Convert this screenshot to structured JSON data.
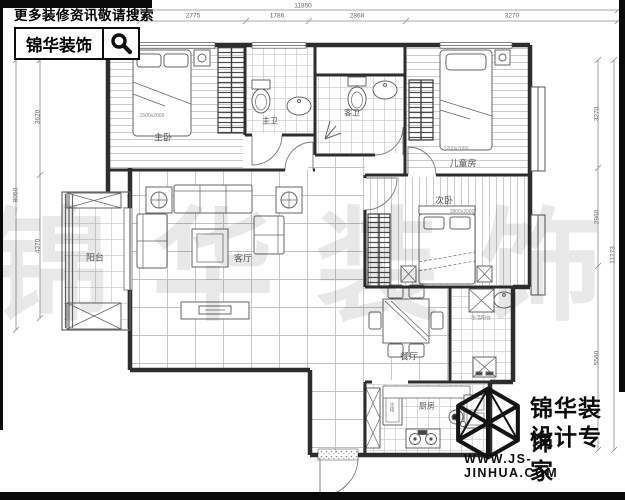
{
  "branding_top": {
    "tagline": "更多装修资讯敬请搜索",
    "brand": "锦华装饰",
    "icon": "magnifier-icon"
  },
  "branding_bottom": {
    "brand": "锦华装饰",
    "subtitle": "设计专家",
    "website": "WWW.JS-JINHUA.COM",
    "icon": "cube-wireframe-icon"
  },
  "watermark": {
    "text": "锦华装饰"
  },
  "rooms": {
    "master_bedroom": "主卧",
    "master_bath": "主卫",
    "guest_bath": "客卫",
    "kids_room": "儿童房",
    "second_bedroom": "次卧",
    "living_room": "客厅",
    "balcony": "阳台",
    "dining_room": "餐厅",
    "kitchen": "厨房",
    "service_area": "生活阳台"
  },
  "annotations": {
    "master_bed_size": "1500x2000",
    "kids_bed_size": "1200x2000",
    "second_bed_size": "1800x2000",
    "fridge": "冰箱"
  },
  "dimensions": {
    "top_overall": "11850",
    "top_segments": [
      "2775",
      "1786",
      "2868",
      "3270"
    ],
    "left_overall": "8050",
    "left_segments": [
      "3620",
      "4370"
    ],
    "right_overall": "11273",
    "right_segments": [
      "3270",
      "2960",
      "5560"
    ]
  }
}
